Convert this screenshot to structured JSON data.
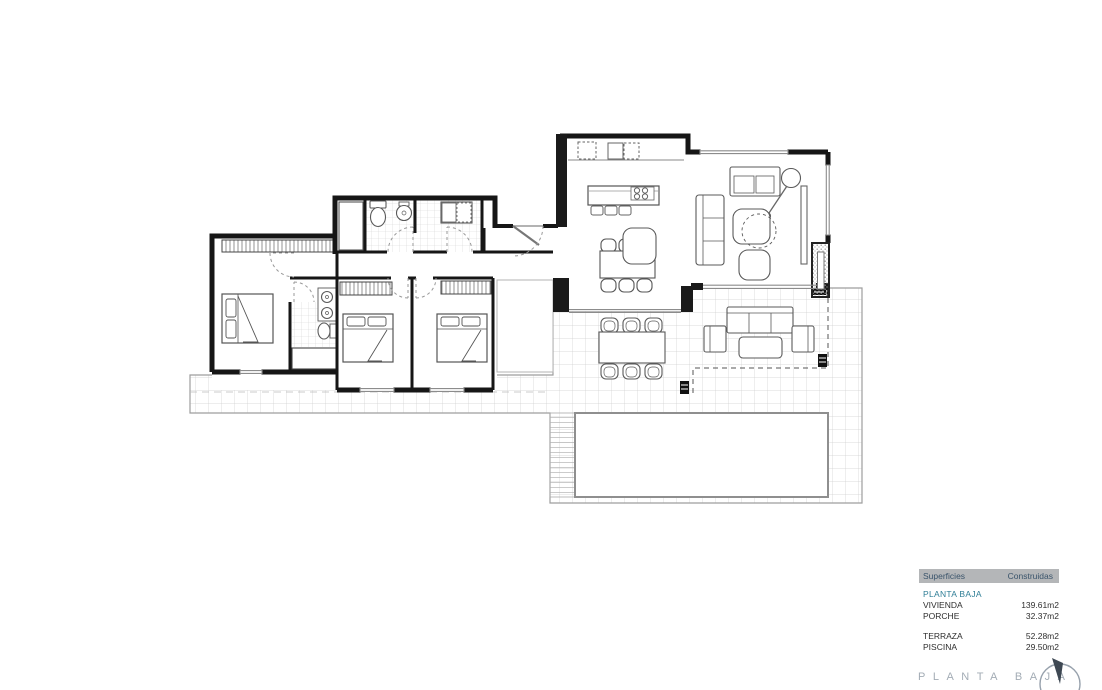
{
  "legend_table": {
    "header": {
      "col1": "Superficies",
      "col2": "Construidas"
    },
    "section": "PLANTA BAJA",
    "groups": [
      {
        "rows": [
          {
            "label": "VIVIENDA",
            "value": "139.61m2"
          },
          {
            "label": "PORCHE",
            "value": "32.37m2"
          }
        ]
      },
      {
        "rows": [
          {
            "label": "TERRAZA",
            "value": "52.28m2"
          },
          {
            "label": "PISCINA",
            "value": "29.50m2"
          }
        ]
      }
    ]
  },
  "footer": {
    "title": "PLANTA BAJA"
  },
  "icons": {
    "compass": "north-compass-icon"
  },
  "colors": {
    "header_bg": "#b4b6b8",
    "header_text": "#3a546b",
    "section_text": "#2f7e96",
    "row_text": "#2e2e2e",
    "footer_text": "#a3acb5",
    "plan_wall": "#161616",
    "terrace_tile_line": "#cfcfcf",
    "dashed_porch_line": "#555555"
  }
}
